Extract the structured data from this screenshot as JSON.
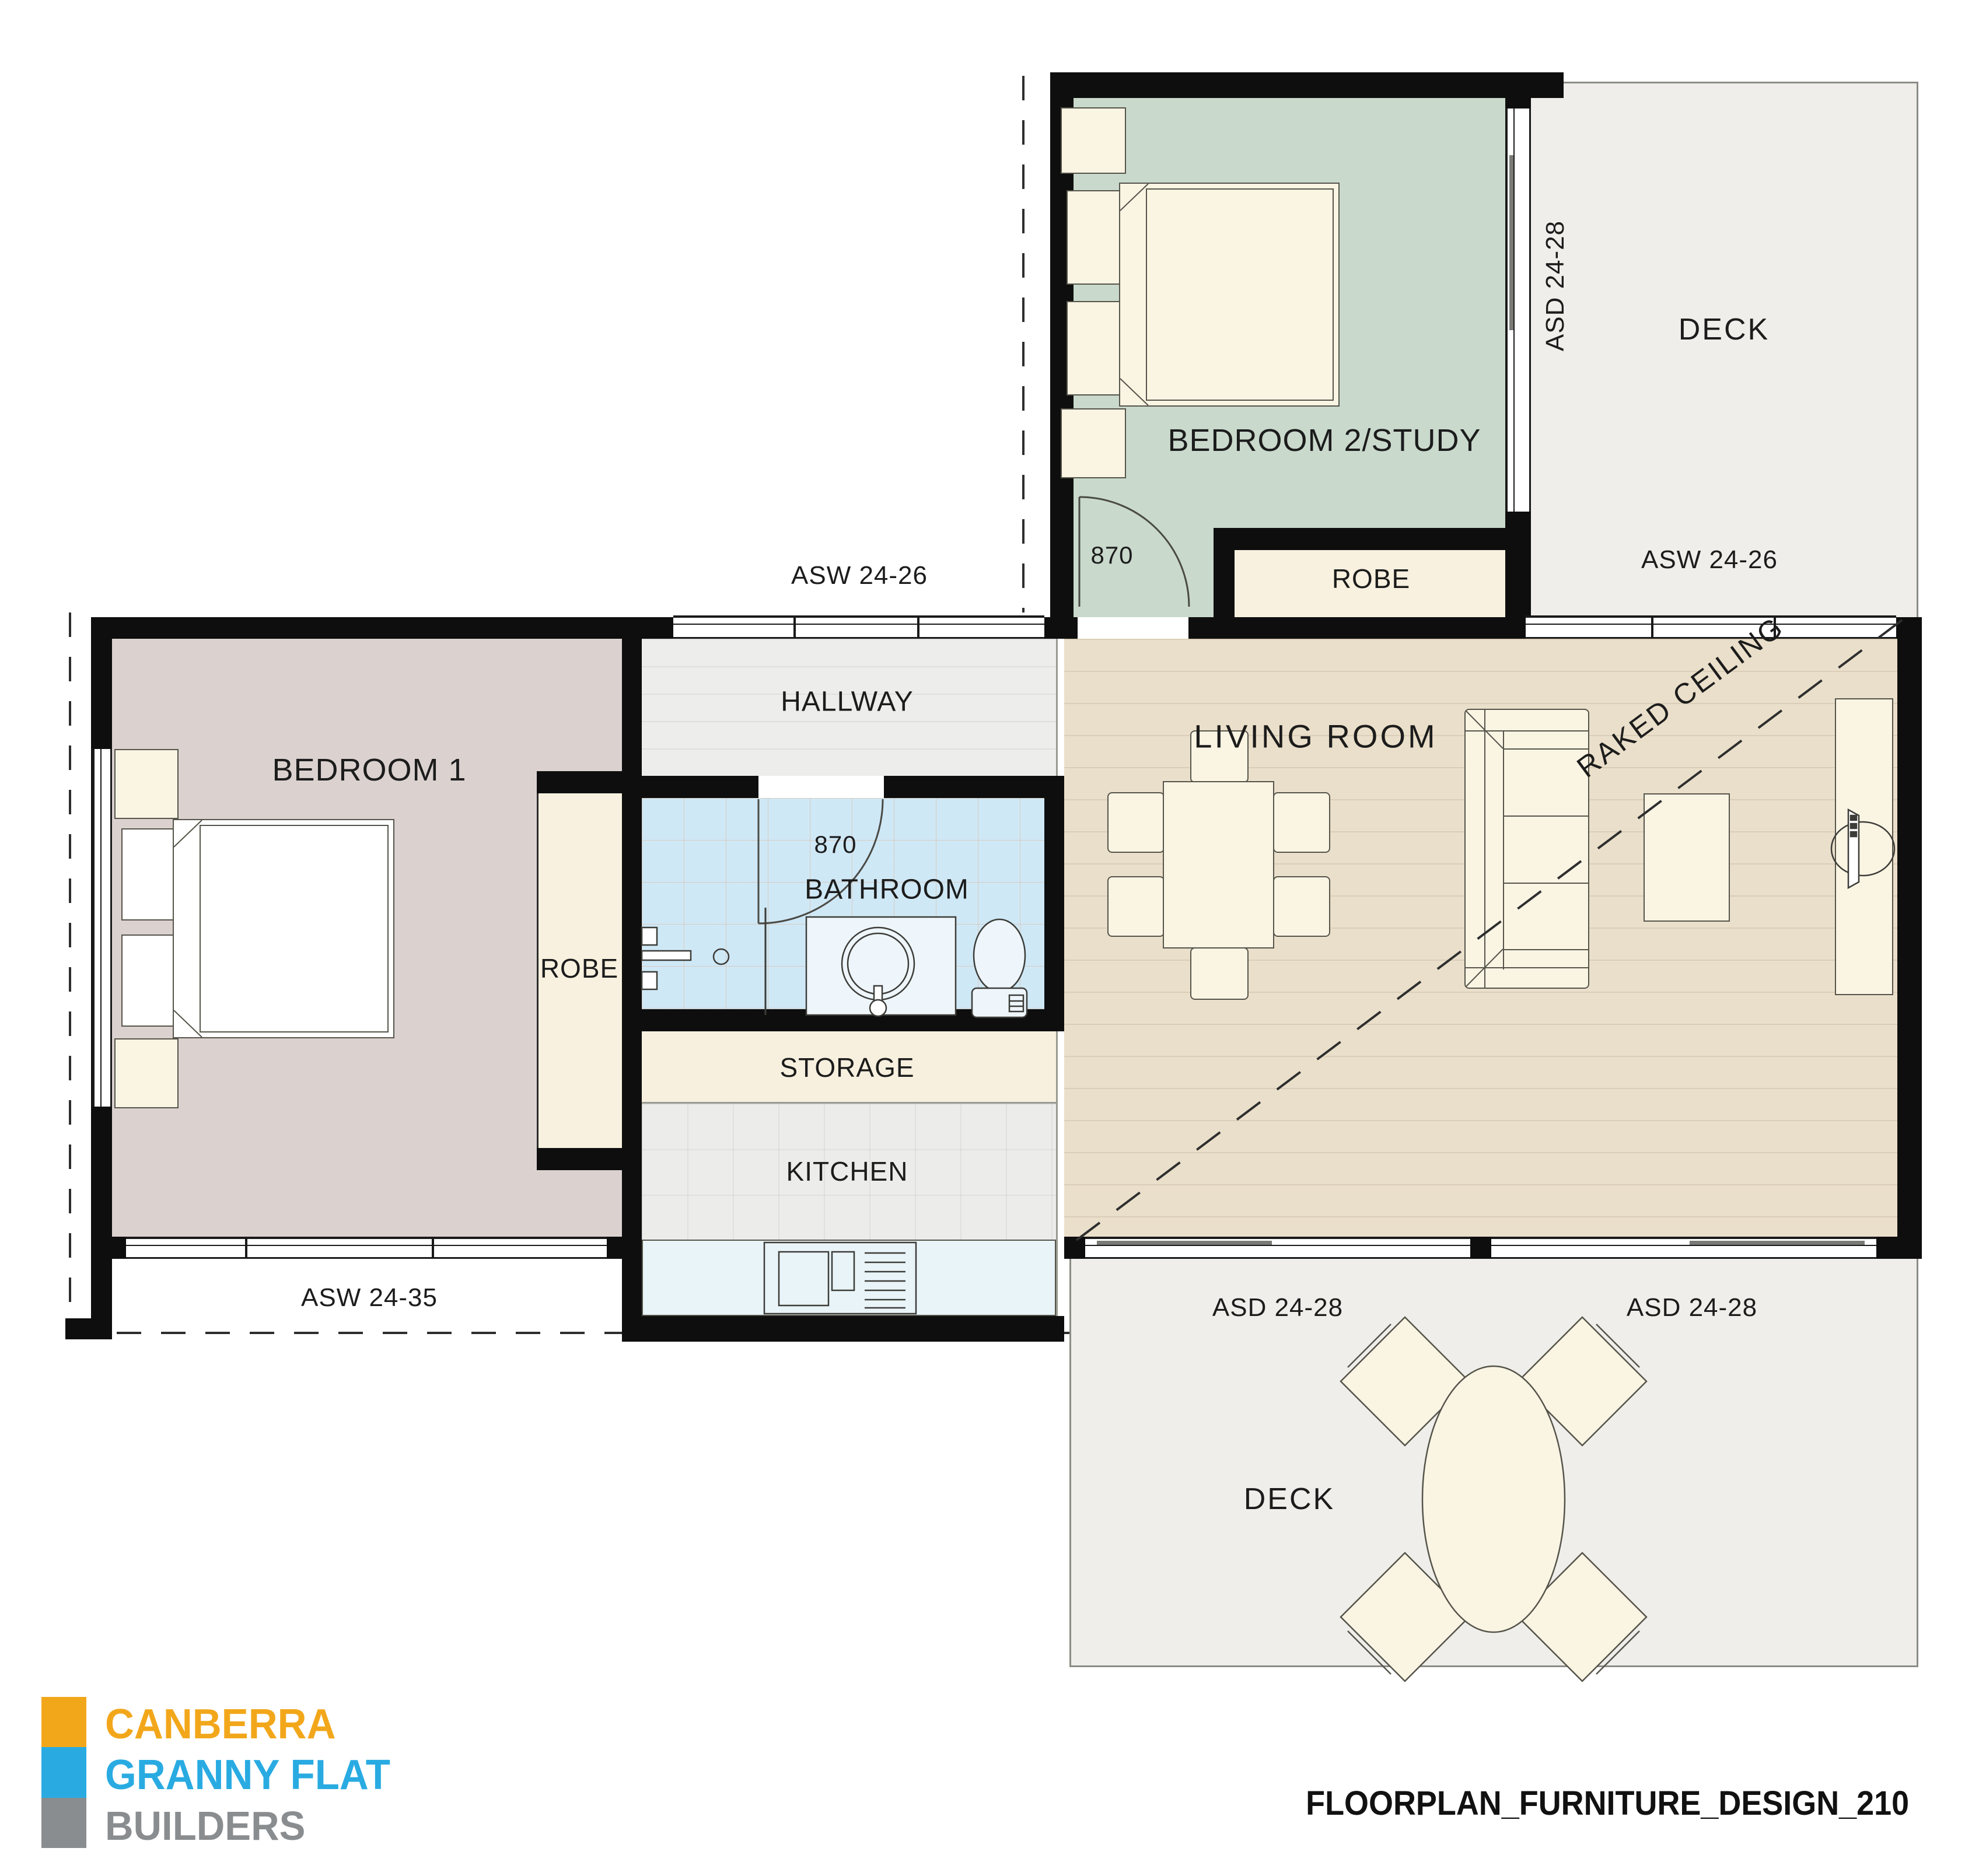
{
  "document": {
    "title": "FLOORPLAN_FURNITURE_DESIGN_210",
    "type": "granny flat floor plan with furniture"
  },
  "logo": {
    "line1": "CANBERRA",
    "line2": "GRANNY FLAT",
    "line3": "BUILDERS",
    "colors": {
      "line1": "#f2a71b",
      "line2": "#29abe2",
      "line3": "#8a8d8f"
    }
  },
  "rooms": {
    "bedroom1": "BEDROOM 1",
    "bedroom2": "BEDROOM 2/STUDY",
    "living": "LIVING ROOM",
    "hallway": "HALLWAY",
    "bathroom": "BATHROOM",
    "storage": "STORAGE",
    "kitchen": "KITCHEN",
    "robe1": "ROBE",
    "robe2": "ROBE",
    "deck_top": "DECK",
    "deck_bottom": "DECK"
  },
  "openings": {
    "asw_hallway": "ASW 24-26",
    "asw_living": "ASW 24-26",
    "asw_bedroom1": "ASW 24-35",
    "asd_deck_top": "ASD 24-28",
    "asd_living_left": "ASD 24-28",
    "asd_living_right": "ASD 24-28",
    "door_bedroom2": "870",
    "door_bathroom": "870"
  },
  "annotations": {
    "raked_ceiling": "RAKED CEILING"
  },
  "colors": {
    "wall": "#0e0e0e",
    "bedroom1_fill": "#dbd2d0",
    "bedroom2_fill": "#c9d9cc",
    "living_fill": "#eadfca",
    "hallway_fill": "#ededeb",
    "bathroom_fill": "#cfe8f6",
    "kitchen_fill": "#ececea",
    "storage_fill": "#f7f0de",
    "robe_fill": "#f8f1df",
    "deck_fill": "#f0eeea",
    "furniture_fill": "#faf4e3",
    "counter_fill": "#e9f4f8"
  }
}
